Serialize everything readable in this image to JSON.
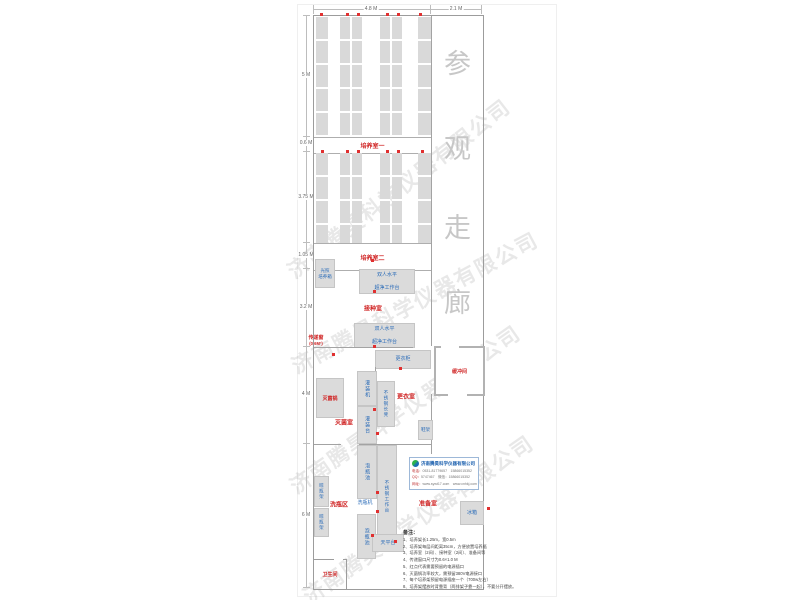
{
  "watermark_text": "济南腾昊科学仪器有限公司",
  "corridor": {
    "chars": [
      "参",
      "观",
      "走",
      "廊"
    ]
  },
  "dims": {
    "top": [
      "4.8 M",
      "2.1 M"
    ],
    "left": [
      "5 M",
      "0.6 M",
      "3.75 M",
      "1.05 M",
      "3.2 M",
      "4 M",
      "6 M"
    ]
  },
  "rooms": {
    "room1": "培养室一",
    "room2": "培养室二",
    "inoculation": "接种室",
    "sterilization": "灭菌室",
    "changing": "更衣室",
    "buffer": "缓冲间",
    "washing": "洗瓶区",
    "prep": "准备室",
    "toilet": "卫生间"
  },
  "equipment": {
    "light_incubator": "光照\n培养箱",
    "clean_bench_line1": "双人水平",
    "clean_bench_line2": "超净工作台",
    "pass_window": "传递窗",
    "pass_window_size": "(0.6M²)",
    "wardrobe": "更衣柜",
    "filling_machine": "灌装机",
    "ss_bench": "不锈钢长凳",
    "sterilizer": "灭菌锅",
    "filling_table": "灌装台",
    "shoe_rack": "鞋架",
    "soak_pool": "泡瓶池",
    "ss_worktable": "不锈钢工作台",
    "bottle_washer": "洗瓶机",
    "dry_rack": "晾瓶架",
    "balance_table": "天平台",
    "fridge": "冰箱"
  },
  "company": {
    "name": "济南腾昊科学仪器有限公司",
    "lines": [
      {
        "k": "电话：",
        "v": "0531-81779657　15866015352"
      },
      {
        "k": "QQ：",
        "v": "5747467　微信：15866015352"
      },
      {
        "k": "网址：",
        "v": "www.sywt17.com　www.cnhkj.com"
      }
    ]
  },
  "notes": {
    "title": "备注：",
    "items": [
      "1、培养架长1.25m，宽0.5m",
      "2、培养架每层间距离35cm，方便放置培养瓶",
      "3、培养室（2间）、接种室（2间）、准备间等",
      "4、传递窗口尺寸为0.6×1.0 M",
      "5、红点代表需要预留的电源插口",
      "6、灭菌锅功率较大，需预留380V电源接口",
      "7、每个培养架预留电源插座一个（700w左右）",
      "8、培养架摆放时背靠背（两排架子靠一起），不要分开摆放。"
    ]
  },
  "colors": {
    "room_label": "#d02525",
    "equipment_label": "#2b6cb8",
    "outlet_dot": "#e03030",
    "corridor_text": "#c7c7c7"
  }
}
